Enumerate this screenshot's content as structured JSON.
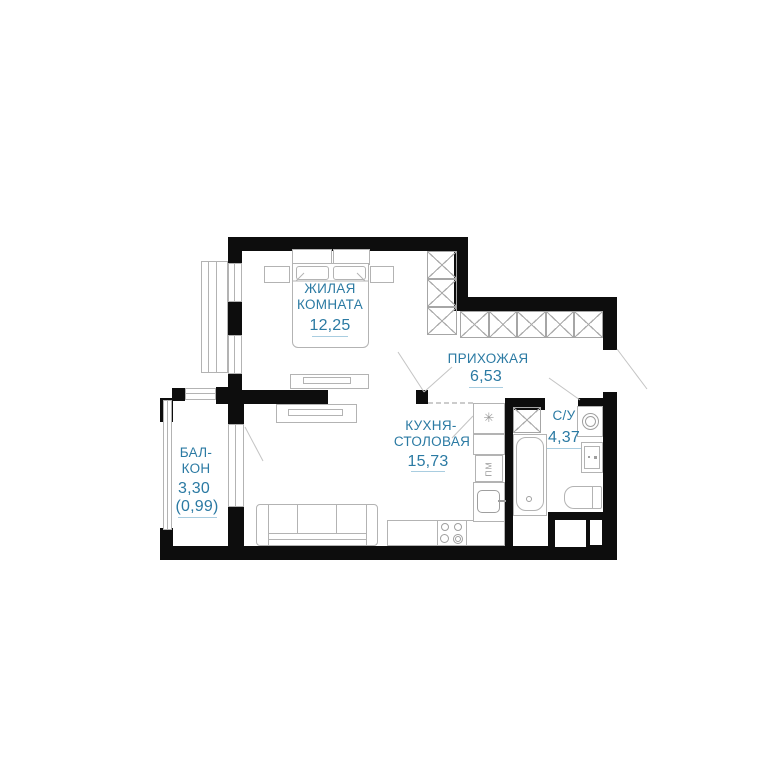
{
  "rooms": {
    "living": {
      "line1": "ЖИЛАЯ",
      "line2": "КОМНАТА",
      "area": "12,25"
    },
    "hallway": {
      "line1": "ПРИХОЖАЯ",
      "area": "6,53"
    },
    "kitchen": {
      "line1": "КУХНЯ-",
      "line2": "СТОЛОВАЯ",
      "area": "15,73"
    },
    "bathroom": {
      "line1": "С/У",
      "area": "4,37"
    },
    "balcony": {
      "line1": "БАЛ-",
      "line2": "КОН",
      "area": "3,30",
      "area_reduced": "(0,99)"
    }
  },
  "appliances": {
    "fridge_icon": "✳",
    "dishwasher_label": "ПМ"
  },
  "colors": {
    "label": "#2b7aa3",
    "wall": "#0d0d0d",
    "furniture_outline": "#b3b3b3",
    "underline": "#a9cde0",
    "background": "#ffffff"
  }
}
